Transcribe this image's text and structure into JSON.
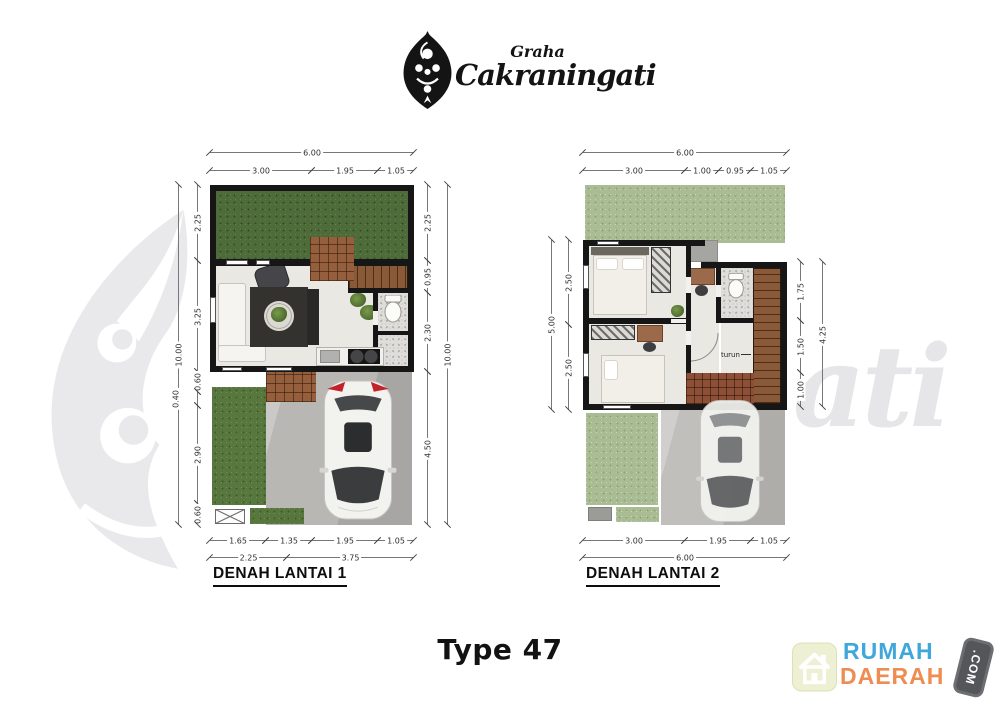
{
  "header": {
    "brand_top": "Graha",
    "brand_name": "Cakraningati"
  },
  "watermark": {
    "tail_text": "ati"
  },
  "plan1": {
    "title": "DENAH LANTAI 1",
    "stairs_label": "naik",
    "dims": {
      "top_total": "6.00",
      "top": [
        "3.00",
        "1.95",
        "1.05"
      ],
      "left_total": "10.00",
      "left": [
        "2.25",
        "3.25",
        "0.60",
        "0.40",
        "2.90",
        "0.60"
      ],
      "right_total": "10.00",
      "right": [
        "2.25",
        "0.95",
        "2.30",
        "4.50"
      ],
      "bottom_inner": [
        "1.65",
        "1.35",
        "1.95",
        "1.05"
      ],
      "bottom_outer": [
        "2.25",
        "3.75"
      ]
    }
  },
  "plan2": {
    "title": "DENAH LANTAI 2",
    "stairs_label": "turun",
    "dims": {
      "top_total": "6.00",
      "top": [
        "3.00",
        "1.00",
        "0.95",
        "1.05"
      ],
      "left_total": "5.00",
      "left": [
        "2.50",
        "2.50"
      ],
      "right_total": "4.25",
      "right": [
        "1.75",
        "1.50",
        "1.00"
      ],
      "bottom_inner": [
        "3.00",
        "1.95",
        "1.05"
      ],
      "bottom_outer": [
        "6.00"
      ]
    }
  },
  "footer": {
    "type_label": "Type 47"
  },
  "brand_badge": {
    "word1": "RUMAH",
    "word2": "DAERAH",
    "tag": ".COM",
    "colors": {
      "blue": "#3fa7da",
      "orange": "#ee8c52",
      "tag_bg": "#55565a",
      "tile": "#eef0d3"
    }
  }
}
